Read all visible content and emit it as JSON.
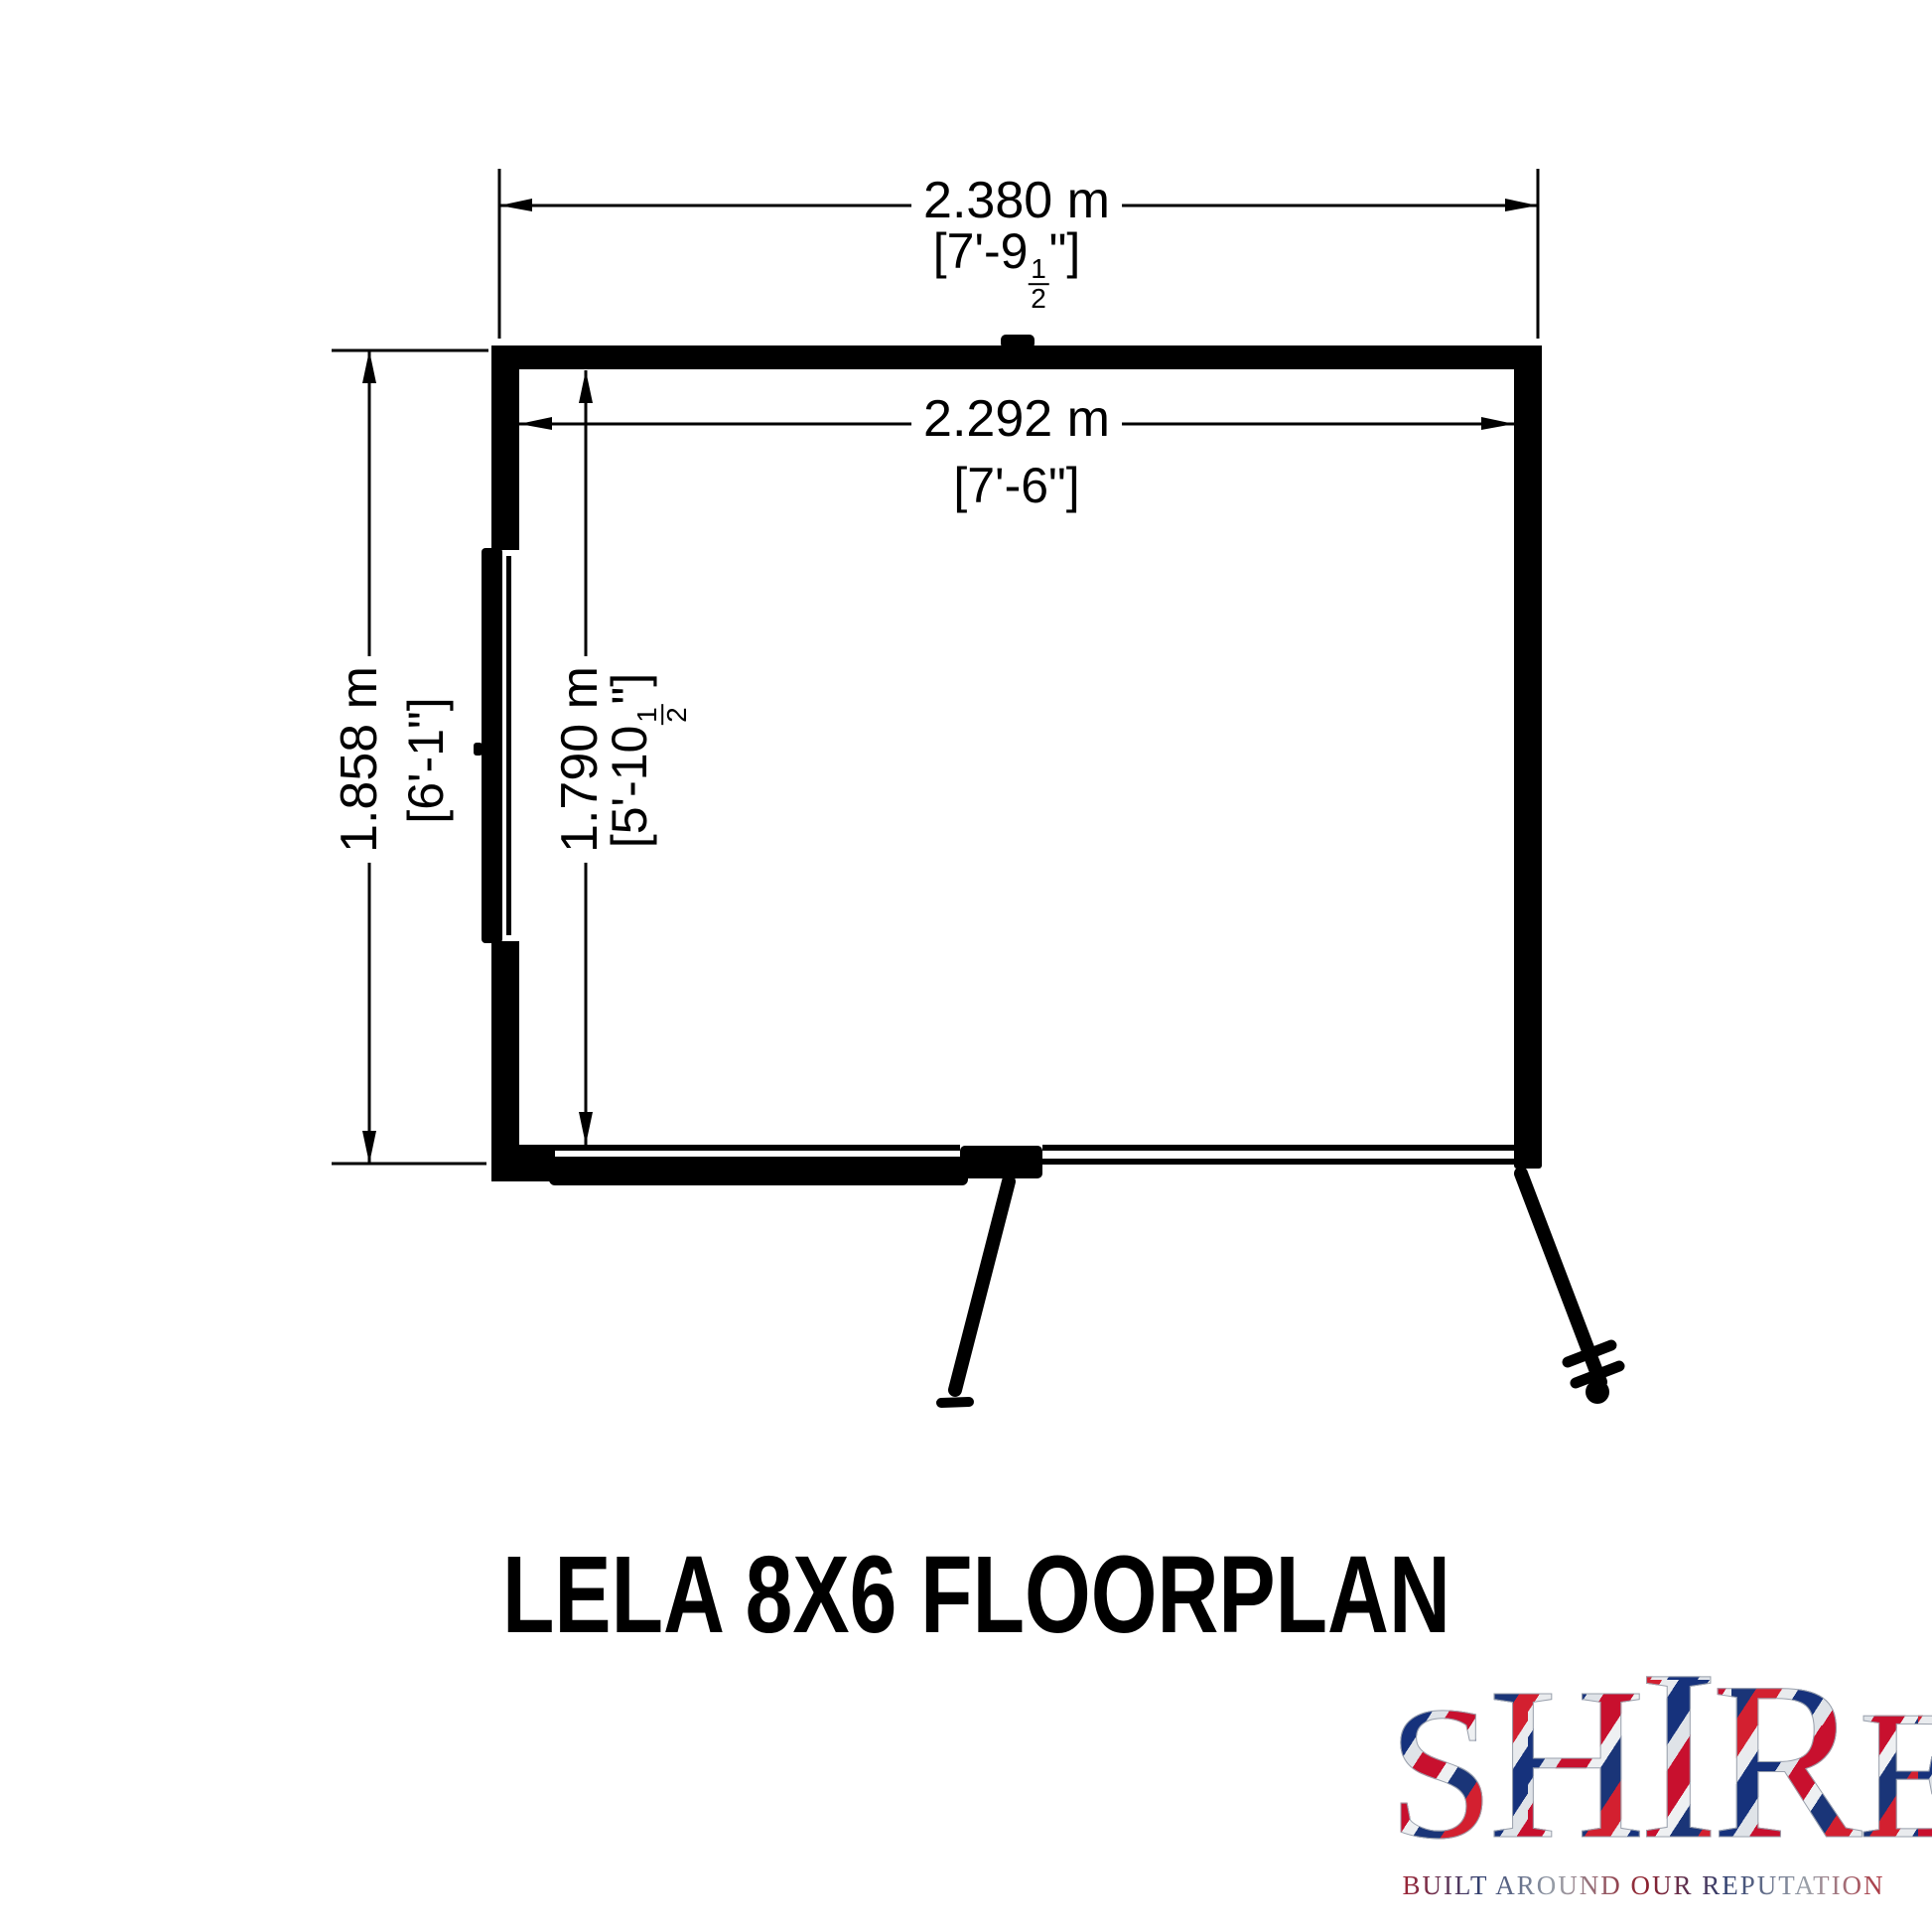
{
  "title": "LELA 8X6 FLOORPLAN",
  "dimensions": {
    "outer_width": {
      "metric": "2.380 m",
      "imperial_prefix": "[7'-9",
      "fraction_numerator": "1",
      "fraction_denominator": "2",
      "imperial_suffix": "\"]"
    },
    "inner_width": {
      "metric": "2.292 m",
      "imperial_prefix": "[7'-6\"]",
      "fraction_numerator": "",
      "fraction_denominator": "",
      "imperial_suffix": ""
    },
    "outer_depth": {
      "metric": "1.858 m",
      "imperial_prefix": "[6'-1\"]",
      "fraction_numerator": "",
      "fraction_denominator": "",
      "imperial_suffix": ""
    },
    "inner_depth": {
      "metric": "1.790 m",
      "imperial_prefix": "[5'-10",
      "fraction_numerator": "1",
      "fraction_denominator": "2",
      "imperial_suffix": "\"]"
    }
  },
  "logo": {
    "word": [
      "S",
      "H",
      "I",
      "R",
      "E"
    ],
    "tagline": "BUILT AROUND OUR REPUTATION",
    "colors": {
      "red": "#c8102e",
      "blue": "#1a3578",
      "silver": "#c9ced6"
    }
  },
  "plan": {
    "line_color": "#000000",
    "background": "#ffffff"
  }
}
